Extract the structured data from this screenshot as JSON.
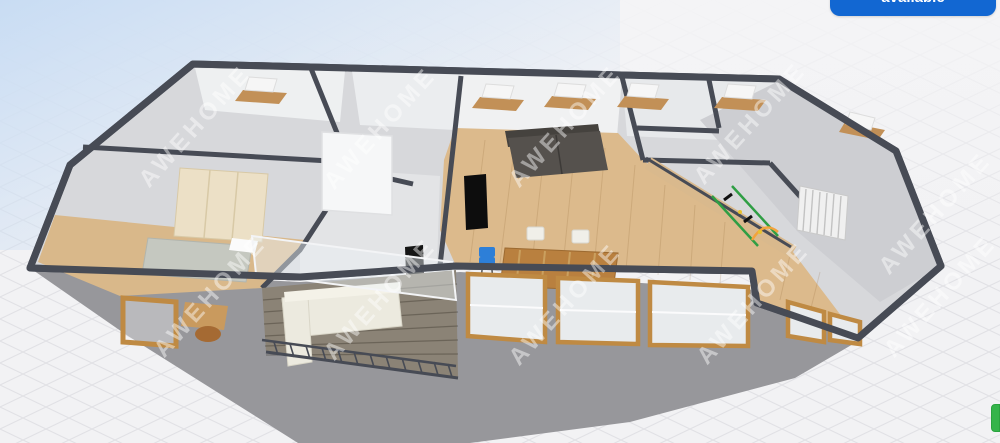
{
  "viewer": {
    "title": "3d-floorplan-viewer",
    "watermark": {
      "text": "AWEHOME"
    },
    "button": {
      "label": "available"
    },
    "colors": {
      "accent": "#1267d2",
      "wallTop": "#474b55",
      "plate": "#d7d8db",
      "wallFace": "#f0f1f2",
      "woodFloor": "#dcba8c",
      "woodFrame": "#bf8a43",
      "grayFloor": "#cdced2",
      "balconyFloor": "#8b8376",
      "sofaDark": "#55514d",
      "sofaCream": "#eceadf",
      "shadow": "#97979b",
      "background": "#f2f2f4",
      "sky": "#c6dbf3",
      "gridLine": "#e1e1e5",
      "watermark": "rgba(255,255,255,0.45)",
      "blueChair": "#2d7fd8",
      "greenTag": "#35b44a"
    }
  }
}
